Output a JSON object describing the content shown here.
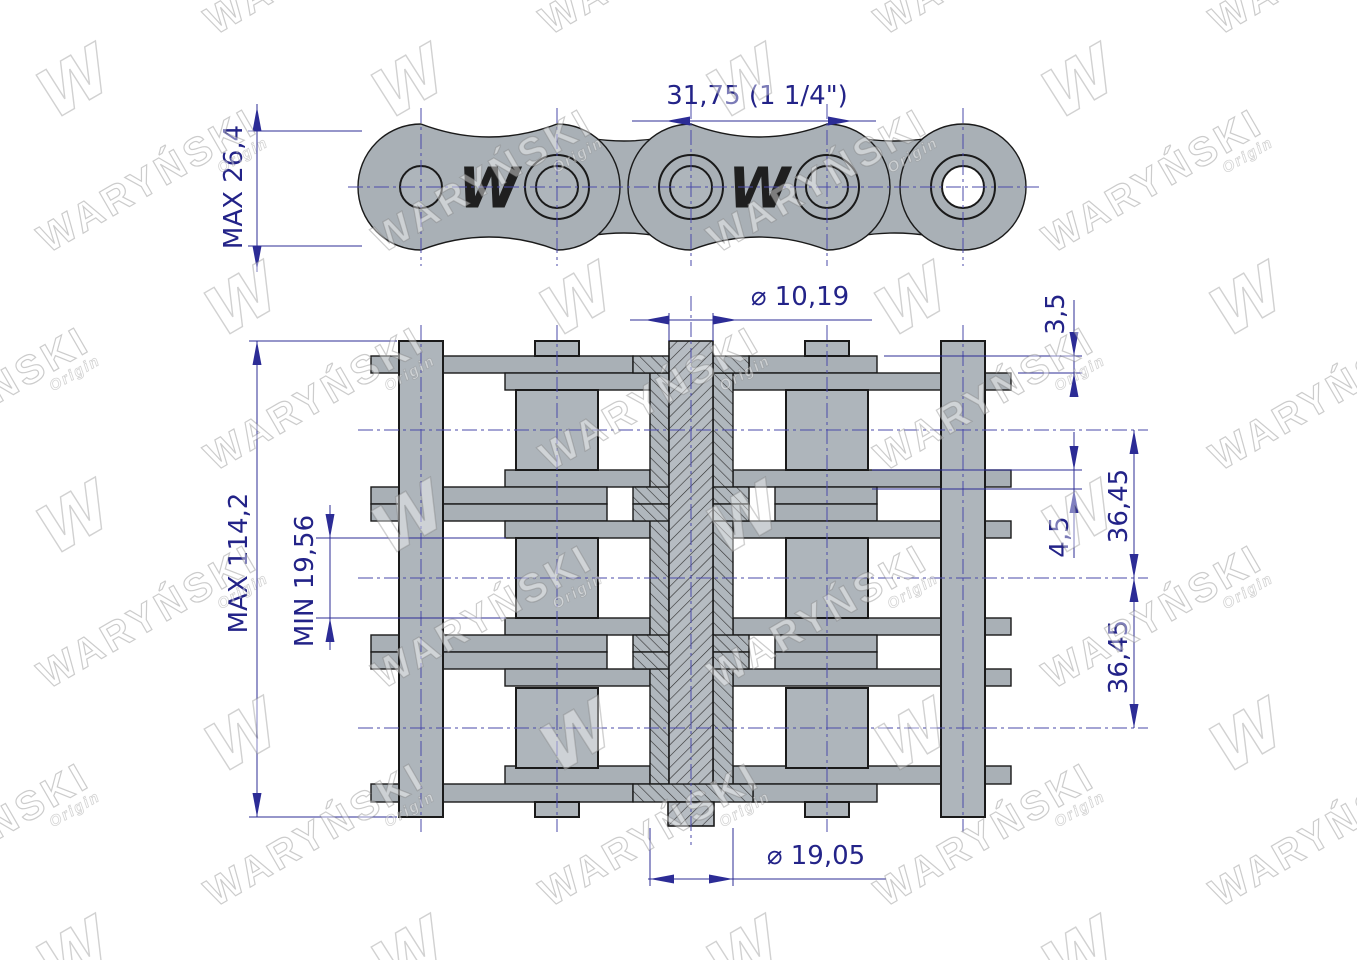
{
  "watermark": {
    "brand": "WARYŃSKI",
    "origin": "Origin",
    "logo": "W"
  },
  "side_view": {
    "plate_logo": "W"
  },
  "dimensions": {
    "pitch": "31,75  (1 1/4\")",
    "plate_height": "MAX 26,4",
    "pin_diameter": "⌀ 10,19",
    "outer_plate_thickness": "3,5",
    "transverse_pitch_1": "36,45",
    "inner_plate_thickness": "4,5",
    "transverse_pitch_2": "36,45",
    "inner_width": "MIN 19,56",
    "overall_width": "MAX 114,2",
    "roller_diameter": "⌀ 19,05"
  }
}
